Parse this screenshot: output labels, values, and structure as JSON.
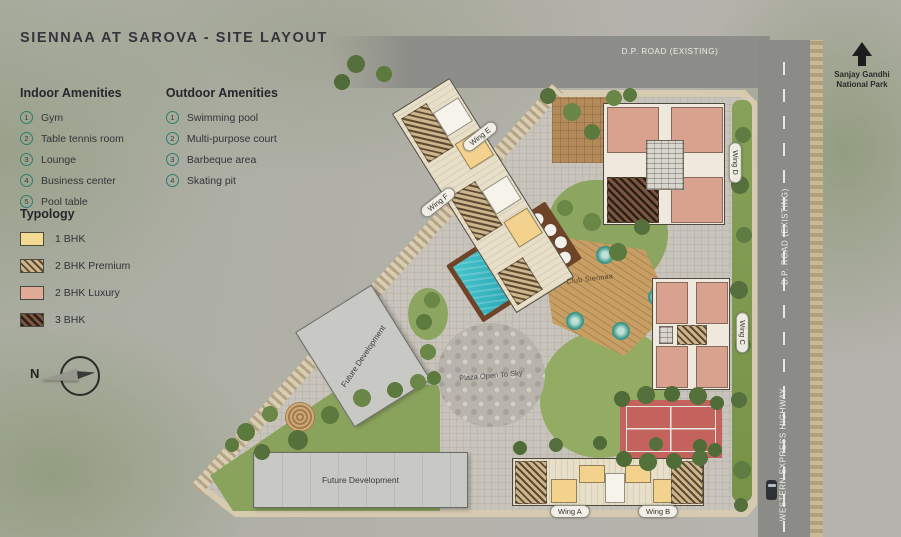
{
  "title": "SIENNAA AT SAROVA - SITE LAYOUT",
  "legend": {
    "indoor": {
      "heading": "Indoor Amenities",
      "items": [
        {
          "num": "1",
          "label": "Gym"
        },
        {
          "num": "2",
          "label": "Table tennis room"
        },
        {
          "num": "3",
          "label": "Lounge"
        },
        {
          "num": "4",
          "label": "Business center"
        },
        {
          "num": "5",
          "label": "Pool table"
        }
      ]
    },
    "outdoor": {
      "heading": "Outdoor Amenities",
      "items": [
        {
          "num": "1",
          "label": "Swimming pool"
        },
        {
          "num": "2",
          "label": "Multi-purpose court"
        },
        {
          "num": "3",
          "label": "Barbeque area"
        },
        {
          "num": "4",
          "label": "Skating pit"
        }
      ]
    },
    "typology": {
      "heading": "Typology",
      "items": [
        {
          "label": "1 BHK",
          "swatch": "solid",
          "color": "#f4d993"
        },
        {
          "label": "2 BHK Premium",
          "swatch": "hatch",
          "color": "#cdb58c"
        },
        {
          "label": "2 BHK Luxury",
          "swatch": "solid",
          "color": "#e0ab97"
        },
        {
          "label": "3 BHK",
          "swatch": "hatch-dark",
          "color": "#7a5640"
        }
      ]
    }
  },
  "compass": {
    "label": "N"
  },
  "map": {
    "roads": {
      "top": {
        "label": "D.P. ROAD (EXISTING)"
      },
      "right": {
        "label": "D.P. ROAD (EXISTING)"
      },
      "highway": {
        "label": "WESTERN EXPRESS HIGHWAY"
      }
    },
    "landmark": {
      "label": "Sanjay Gandhi National Park"
    },
    "wings": [
      {
        "id": "wing-e",
        "label": "Wing E"
      },
      {
        "id": "wing-f",
        "label": "Wing F"
      },
      {
        "id": "wing-d",
        "label": "Wing D"
      },
      {
        "id": "wing-c",
        "label": "Wing C"
      },
      {
        "id": "wing-a",
        "label": "Wing A"
      },
      {
        "id": "wing-b",
        "label": "Wing B"
      }
    ],
    "areas": {
      "club": {
        "label": "Club Siennaa"
      },
      "plaza": {
        "label": "Plaza Open To Sky"
      },
      "future1": {
        "label": "Future Development"
      },
      "future2": {
        "label": "Future Development"
      }
    }
  },
  "colors": {
    "pool": "#38b6c2",
    "court": "#c4635d",
    "road": "#8d8d89",
    "site_ground": "#c8c4bb",
    "site_edge": "#d6cab0"
  }
}
